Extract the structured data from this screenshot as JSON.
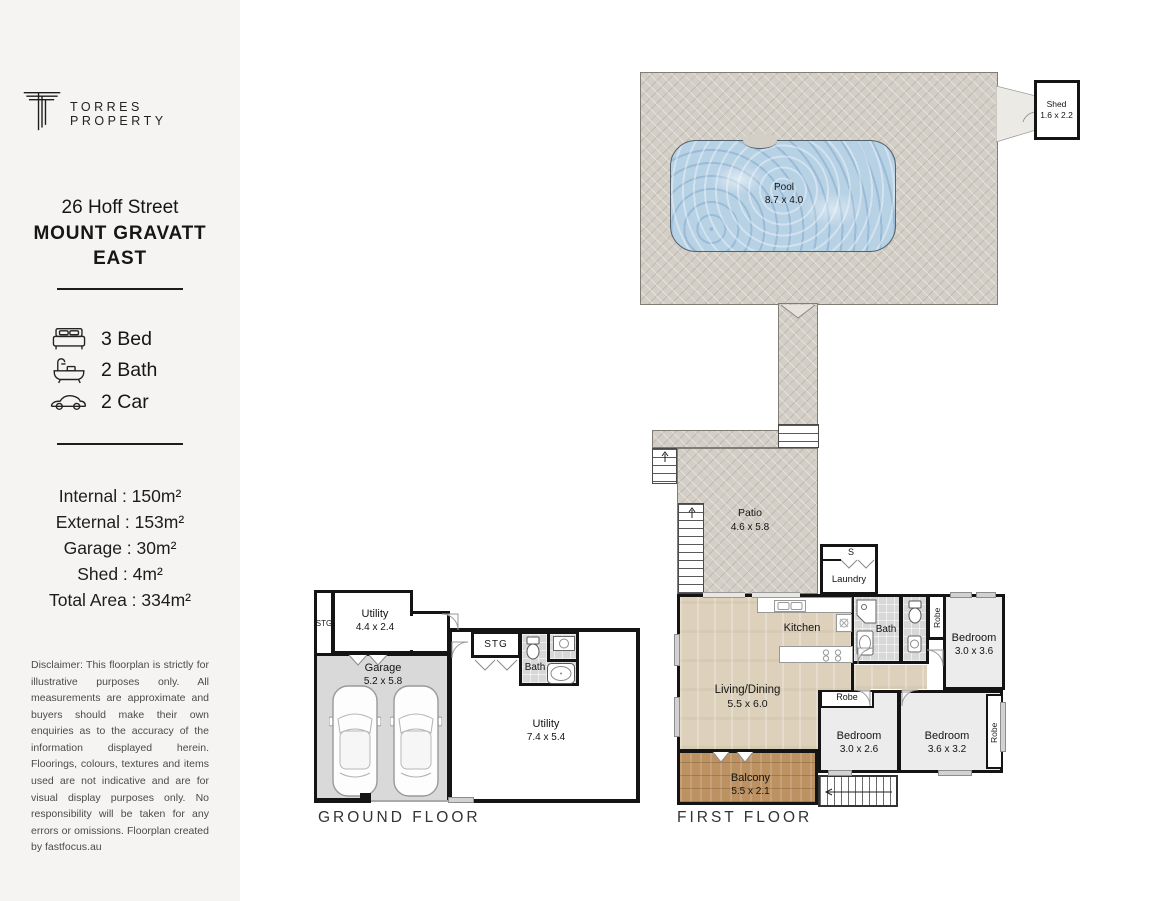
{
  "brand": {
    "name": "TORRES PROPERTY"
  },
  "listing": {
    "address_line1": "26 Hoff Street",
    "address_line2": "MOUNT GRAVATT",
    "address_line3": "EAST"
  },
  "features": {
    "bed": "3 Bed",
    "bath": "2 Bath",
    "car": "2 Car"
  },
  "areas": {
    "internal": "Internal : 150m²",
    "external": "External : 153m²",
    "garage": "Garage : 30m²",
    "shed": "Shed : 4m²",
    "total": "Total Area : 334m²"
  },
  "disclaimer": "Disclaimer: This floorplan is strictly for illustrative purposes only. All measurements are approximate and buyers should make their own enquiries as to the accuracy of the information displayed herein. Floorings, colours, textures and items used are not indicative and are for visual display purposes only. No responsibility will be taken for any errors or omissions. Floorplan created by fastfocus.au",
  "floors": {
    "ground": "GROUND FLOOR",
    "first": "FIRST FLOOR"
  },
  "rooms": {
    "pool": {
      "name": "Pool",
      "dims": "8.7 x 4.0"
    },
    "shed": {
      "name": "Shed",
      "dims": "1.6 x 2.2"
    },
    "patio": {
      "name": "Patio",
      "dims": "4.6 x 5.8"
    },
    "laundry": {
      "name": "Laundry",
      "storage": "S"
    },
    "kitchen": {
      "name": "Kitchen"
    },
    "living": {
      "name": "Living/Dining",
      "dims": "5.5 x 6.0"
    },
    "bath_first": {
      "name": "Bath"
    },
    "robe_bed1": {
      "name": "Robe"
    },
    "bed1": {
      "name": "Bedroom",
      "dims": "3.0 x 3.6"
    },
    "robe_bed2": {
      "name": "Robe"
    },
    "bed2": {
      "name": "Bedroom",
      "dims": "3.0 x 2.6"
    },
    "bed3": {
      "name": "Bedroom",
      "dims": "3.6 x 3.2"
    },
    "robe_bed3": {
      "name": "Robe"
    },
    "balcony": {
      "name": "Balcony",
      "dims": "5.5 x 2.1"
    },
    "stg_left": {
      "name": "STG"
    },
    "utility_upper": {
      "name": "Utility",
      "dims": "4.4 x 2.4"
    },
    "garage": {
      "name": "Garage",
      "dims": "5.2 x 5.8"
    },
    "stg_mid": {
      "name": "STG"
    },
    "bath_ground": {
      "name": "Bath"
    },
    "utility_main": {
      "name": "Utility",
      "dims": "7.4 x 5.4"
    }
  },
  "colors": {
    "paving": "#d3cfc7",
    "pool": "#b7d1e5",
    "wood": "#ddd1bc",
    "deck": "#bd9262",
    "garage": "#d9d9d9",
    "tile": "#d8d8d8",
    "bedroom": "#ececec",
    "wall": "#141414",
    "sidebar": "#f5f4f2",
    "ink": "#1d1d1d"
  }
}
